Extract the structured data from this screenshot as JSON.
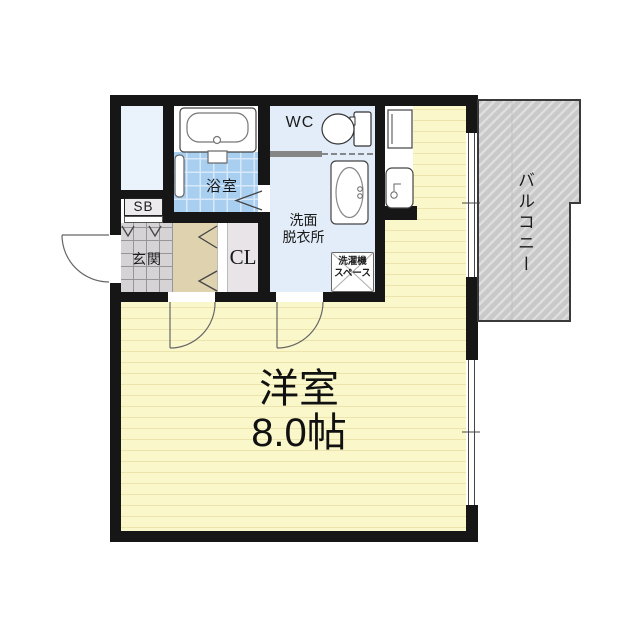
{
  "floorplan": {
    "title": "apartment-floor-plan",
    "labels": {
      "main_room_name": "洋室",
      "main_room_size": "8.0帖",
      "bathroom": "浴室",
      "toilet": "WC",
      "washroom_line1": "洗面",
      "washroom_line2": "脱衣所",
      "laundry_line1": "洗濯機",
      "laundry_line2": "スペース",
      "entrance": "玄関",
      "shoe_box": "SB",
      "closet": "CL",
      "balcony": "バルコニー"
    },
    "colors": {
      "wall": "#161616",
      "main_room_floor": "#FAF7CB",
      "floor_stripe": "#EDE3AC",
      "bathroom_tile": "#A8CEF0",
      "water_rooms": "#E2EDF9",
      "shaft": "#EAF2FB",
      "entrance_tile": "#D5D3D5",
      "hallway_floor": "#DFD3AF",
      "closet_floor": "#E8E4E8",
      "balcony_floor": "#C9C9C9"
    }
  }
}
